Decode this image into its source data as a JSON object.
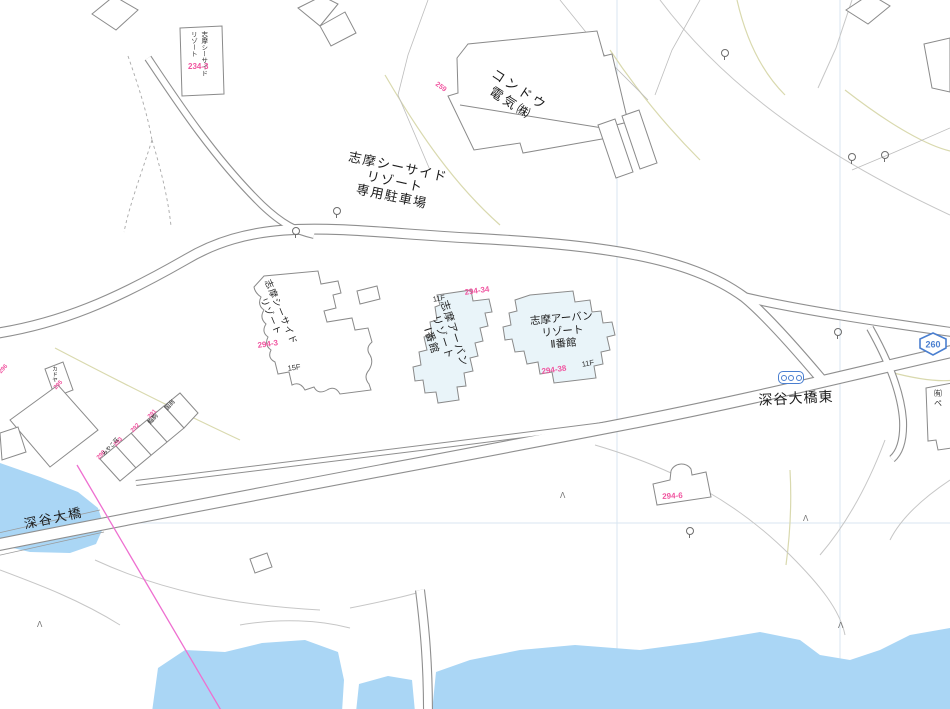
{
  "labels": {
    "kondo_denki": "コンドウ\n電気㈱",
    "parking": "志摩シーサイド\nリゾート\n専用駐車場",
    "seaside_resort": "志摩シーサイド\nリゾート",
    "urban_resort_1": "志摩アーバン\nリゾート\nⅠ番館",
    "urban_resort_2": "志摩アーバン\nリゾート\nⅡ番館",
    "fukaya_ohashi_higashi": "深谷大橋東",
    "fukaya_ohashi": "深谷大橋",
    "route_260": "260",
    "floor_urban1": "11F",
    "floor_urban2": "11F",
    "floor_seaside": "15F",
    "signbox_text": "志摩シーサイド\nリゾート",
    "yuugen_partial": "㈲\nペ"
  },
  "parcels": {
    "signbox": "234-3",
    "kondo": "259",
    "seaside": "294-3",
    "urban1": "294-34",
    "urban2": "294-38",
    "south_building": "294-6",
    "kadoya": "295",
    "left_edge": "296",
    "shop_row": [
      "291",
      "292",
      "293",
      "290"
    ]
  },
  "shops": {
    "s1": "国商",
    "s2": "鮨駒",
    "s3": "みやこ荘",
    "kadoya": "カドヤ"
  },
  "icons": {
    "conifer": "Λ"
  },
  "colors": {
    "water": "#aad6f5",
    "highlight_building": "#e9f4f9",
    "parcel_pink": "#f055a0",
    "route_blue": "#4a7fd0",
    "boundary_magenta": "#ee6fd0"
  }
}
